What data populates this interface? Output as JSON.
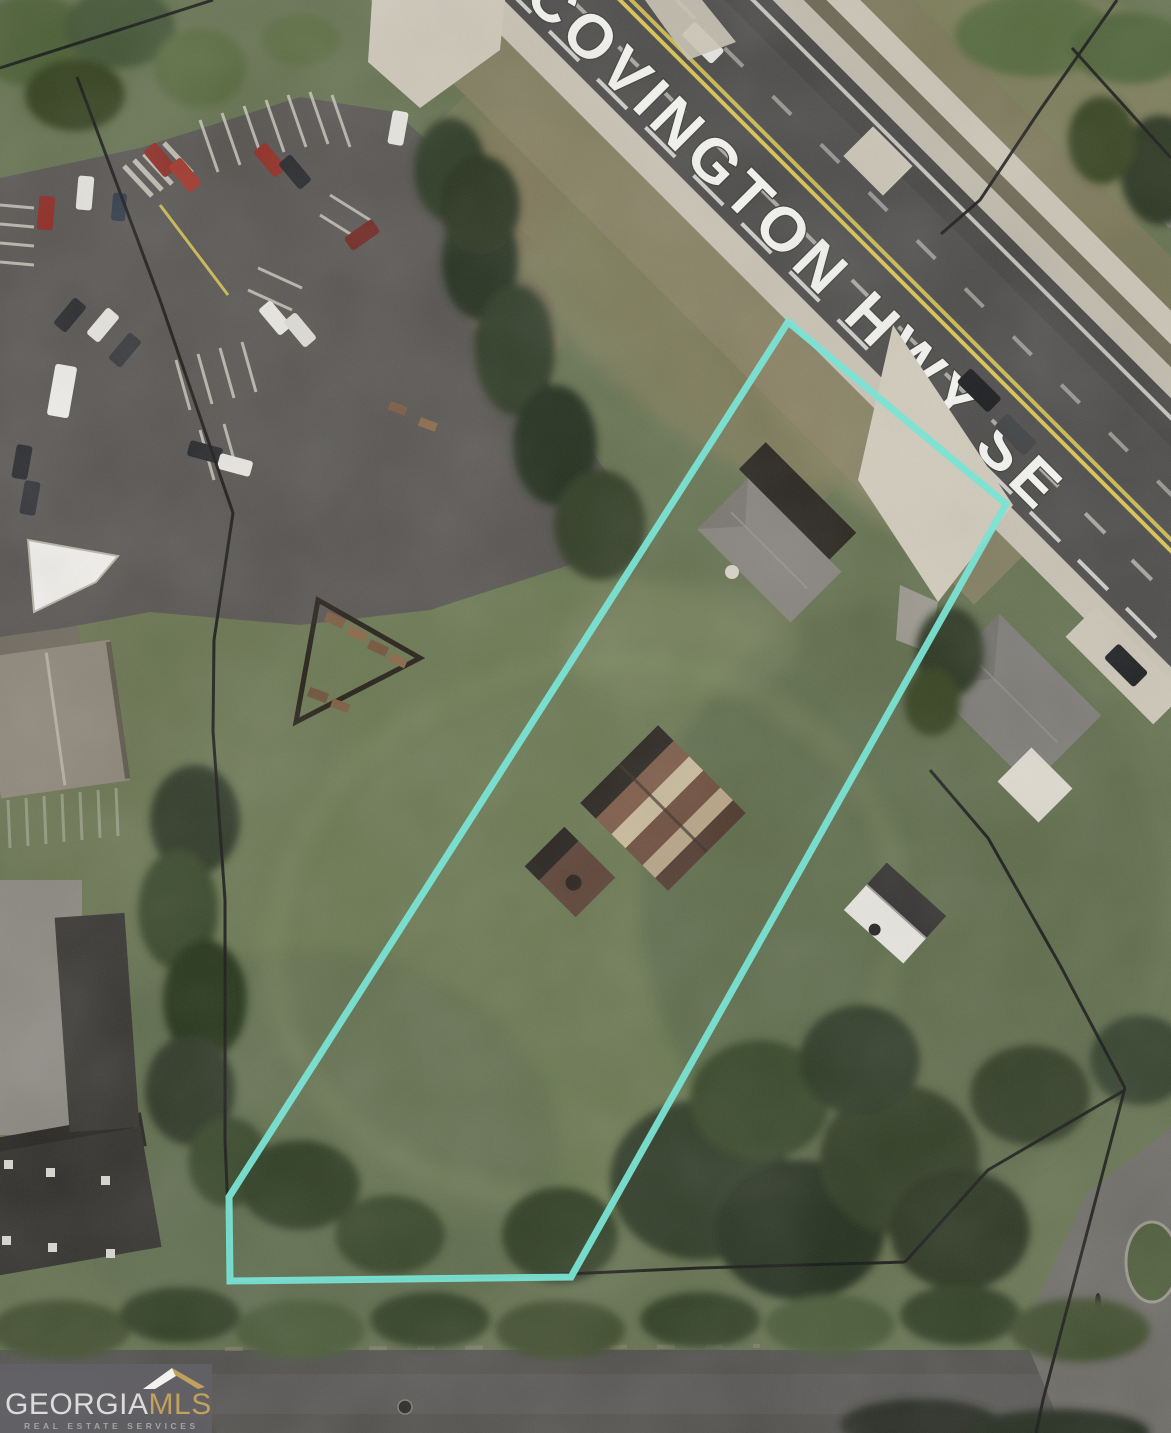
{
  "map": {
    "road_label": "COVINGTON HWY SE",
    "road": {
      "surface_color": "#4a4948",
      "center_line_color": "#d9c652",
      "label_color": "#fbfbf8"
    },
    "parcel_outline": {
      "color": "#7ae3d4",
      "points": "788,322 1006,504 571,1277 230,1281 229,1197"
    }
  },
  "watermark": {
    "brand_primary": "GEORGIA",
    "brand_secondary": "MLS",
    "tagline": "REAL ESTATE SERVICES",
    "brand_secondary_color": "#c2a05d",
    "panel_color": "#626165"
  }
}
